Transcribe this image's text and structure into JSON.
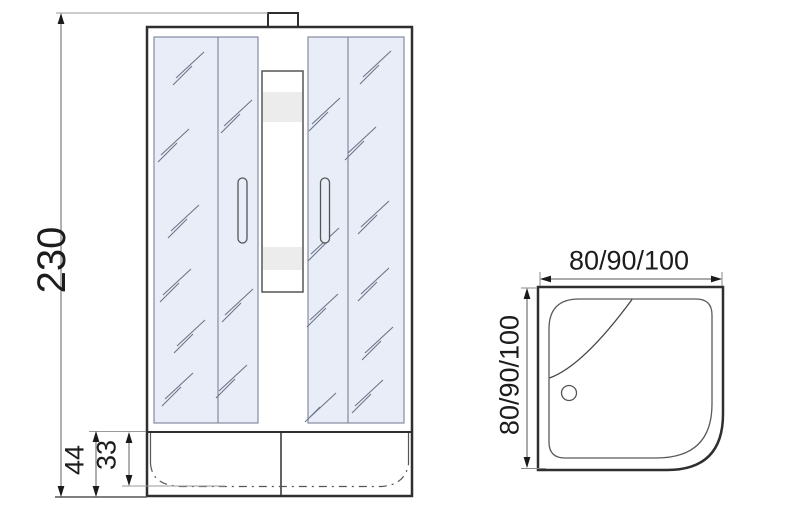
{
  "front_view": {
    "height_label": "230",
    "apron_height_label": "44",
    "tray_inner_depth_label": "33"
  },
  "top_view": {
    "width_label": "80/90/100",
    "depth_label": "80/90/100"
  },
  "colors": {
    "line_dark": "#2f2f2f",
    "line_dim": "#606060",
    "line_ext": "#9a9a9a",
    "glass_fill": "#e9edf8",
    "glass_border": "#858ca0",
    "hatch": "#6e7588",
    "band_fill": "#ececec",
    "background": "#ffffff"
  }
}
